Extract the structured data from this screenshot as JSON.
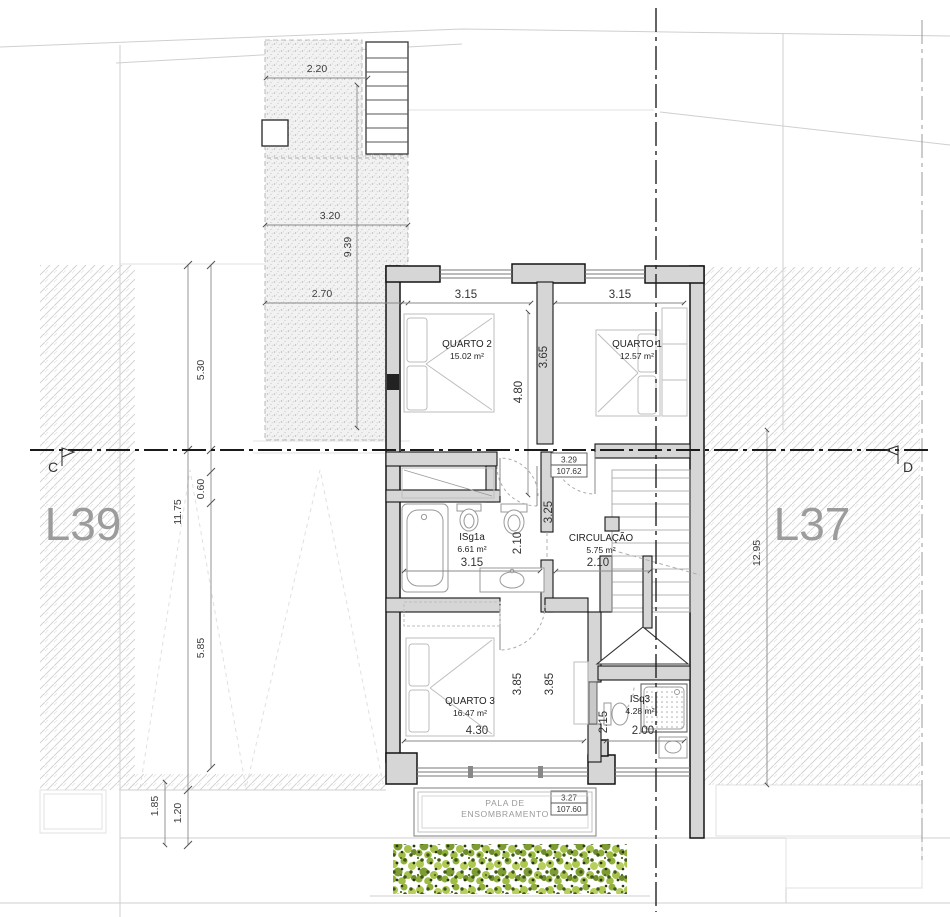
{
  "drawing_type": "floor-plan",
  "lots": {
    "left": "L39",
    "right": "L37"
  },
  "sections": {
    "left": "C",
    "right": "D"
  },
  "rooms": {
    "quarto2": {
      "name": "QUARTO 2",
      "area": "15.02 m²"
    },
    "quarto1": {
      "name": "QUARTO 1",
      "area": "12.57 m²"
    },
    "isg1a": {
      "name": "ISg1a",
      "area": "6.61 m²"
    },
    "circulacao": {
      "name": "CIRCULAÇÃO",
      "area": "5.75 m²"
    },
    "quarto3": {
      "name": "QUARTO 3",
      "area": "16.47 m²"
    },
    "isq3": {
      "name": "ISq3",
      "area": "4.28 m²"
    }
  },
  "canopy": {
    "line1": "PALA DE",
    "line2": "ENSOMBRAMENTO"
  },
  "levels": {
    "upper": {
      "rel": "3.29",
      "abs": "107.62"
    },
    "canopy": {
      "rel": "3.27",
      "abs": "107.60"
    }
  },
  "dims": {
    "terrace_width": "2.20",
    "terrace_upper": "3.20",
    "terrace_length": "9.39",
    "terrace_lower": "2.70",
    "left_top": "5.30",
    "left_total": "11.75",
    "left_offset": "0.60",
    "left_mid": "5.85",
    "left_low1": "1.85",
    "left_low2": "1.20",
    "q2_width": "3.15",
    "q1_width": "3.15",
    "q2_height": "4.80",
    "q1_height": "3.65",
    "hall_len": "3.25",
    "bath_depth": "2.10",
    "bath_width": "3.15",
    "circ_width": "2.10",
    "q3_width": "4.30",
    "q3_height": "3.85",
    "q3_height2": "3.85",
    "isq3_depth": "2.15",
    "isq3_width": "2.00",
    "lot_right": "12.95"
  },
  "colors": {
    "wall_fill": "#d6d6d6",
    "hatch": "#d4d4d4",
    "hedge_light": "#aec84f",
    "hedge_dark": "#3c5718",
    "lot_label": "#9c9c9c"
  }
}
